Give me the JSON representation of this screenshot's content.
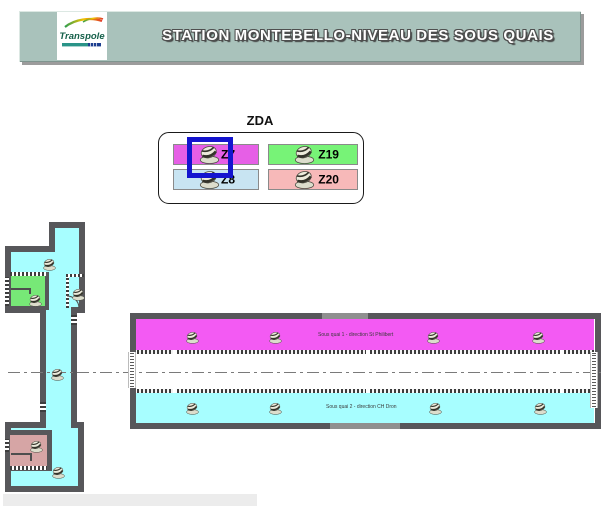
{
  "header": {
    "title": "STATION MONTEBELLO-NIVEAU DES SOUS QUAIS",
    "logo_text": "Transpole",
    "colors": {
      "bar_bg": "#a9c2bb",
      "logo_green": "#15604a",
      "logo_teal": "#2a9488",
      "logo_navy": "#1d3e8f"
    }
  },
  "legend": {
    "title": "ZDA",
    "items": [
      {
        "label": "Z7",
        "color": "#e65fe6"
      },
      {
        "label": "Z19",
        "color": "#77f377"
      },
      {
        "label": "Z8",
        "color": "#c8e4f2"
      },
      {
        "label": "Z20",
        "color": "#f7b9b9"
      }
    ],
    "selected_item": "Z7",
    "selection_color": "#1414cf"
  },
  "plan": {
    "labels": {
      "platform_top": "Sous quai 1 - direction St Philibert",
      "platform_bottom": "Sous quai 2 - direction CH Dron"
    },
    "colors": {
      "wall": "#57575a",
      "corridor": "#a7feff",
      "platform_top": "#f35af3",
      "room_green": "#77e877",
      "room_pink": "#d6a5a5"
    },
    "detectors": [
      {
        "x": 49,
        "y": 264
      },
      {
        "x": 35,
        "y": 300
      },
      {
        "x": 78,
        "y": 294
      },
      {
        "x": 57,
        "y": 374
      },
      {
        "x": 36,
        "y": 446
      },
      {
        "x": 58,
        "y": 472
      },
      {
        "x": 192,
        "y": 337
      },
      {
        "x": 275,
        "y": 337
      },
      {
        "x": 433,
        "y": 337
      },
      {
        "x": 538,
        "y": 337
      },
      {
        "x": 192,
        "y": 408
      },
      {
        "x": 275,
        "y": 408
      },
      {
        "x": 435,
        "y": 408
      },
      {
        "x": 540,
        "y": 408
      }
    ]
  }
}
